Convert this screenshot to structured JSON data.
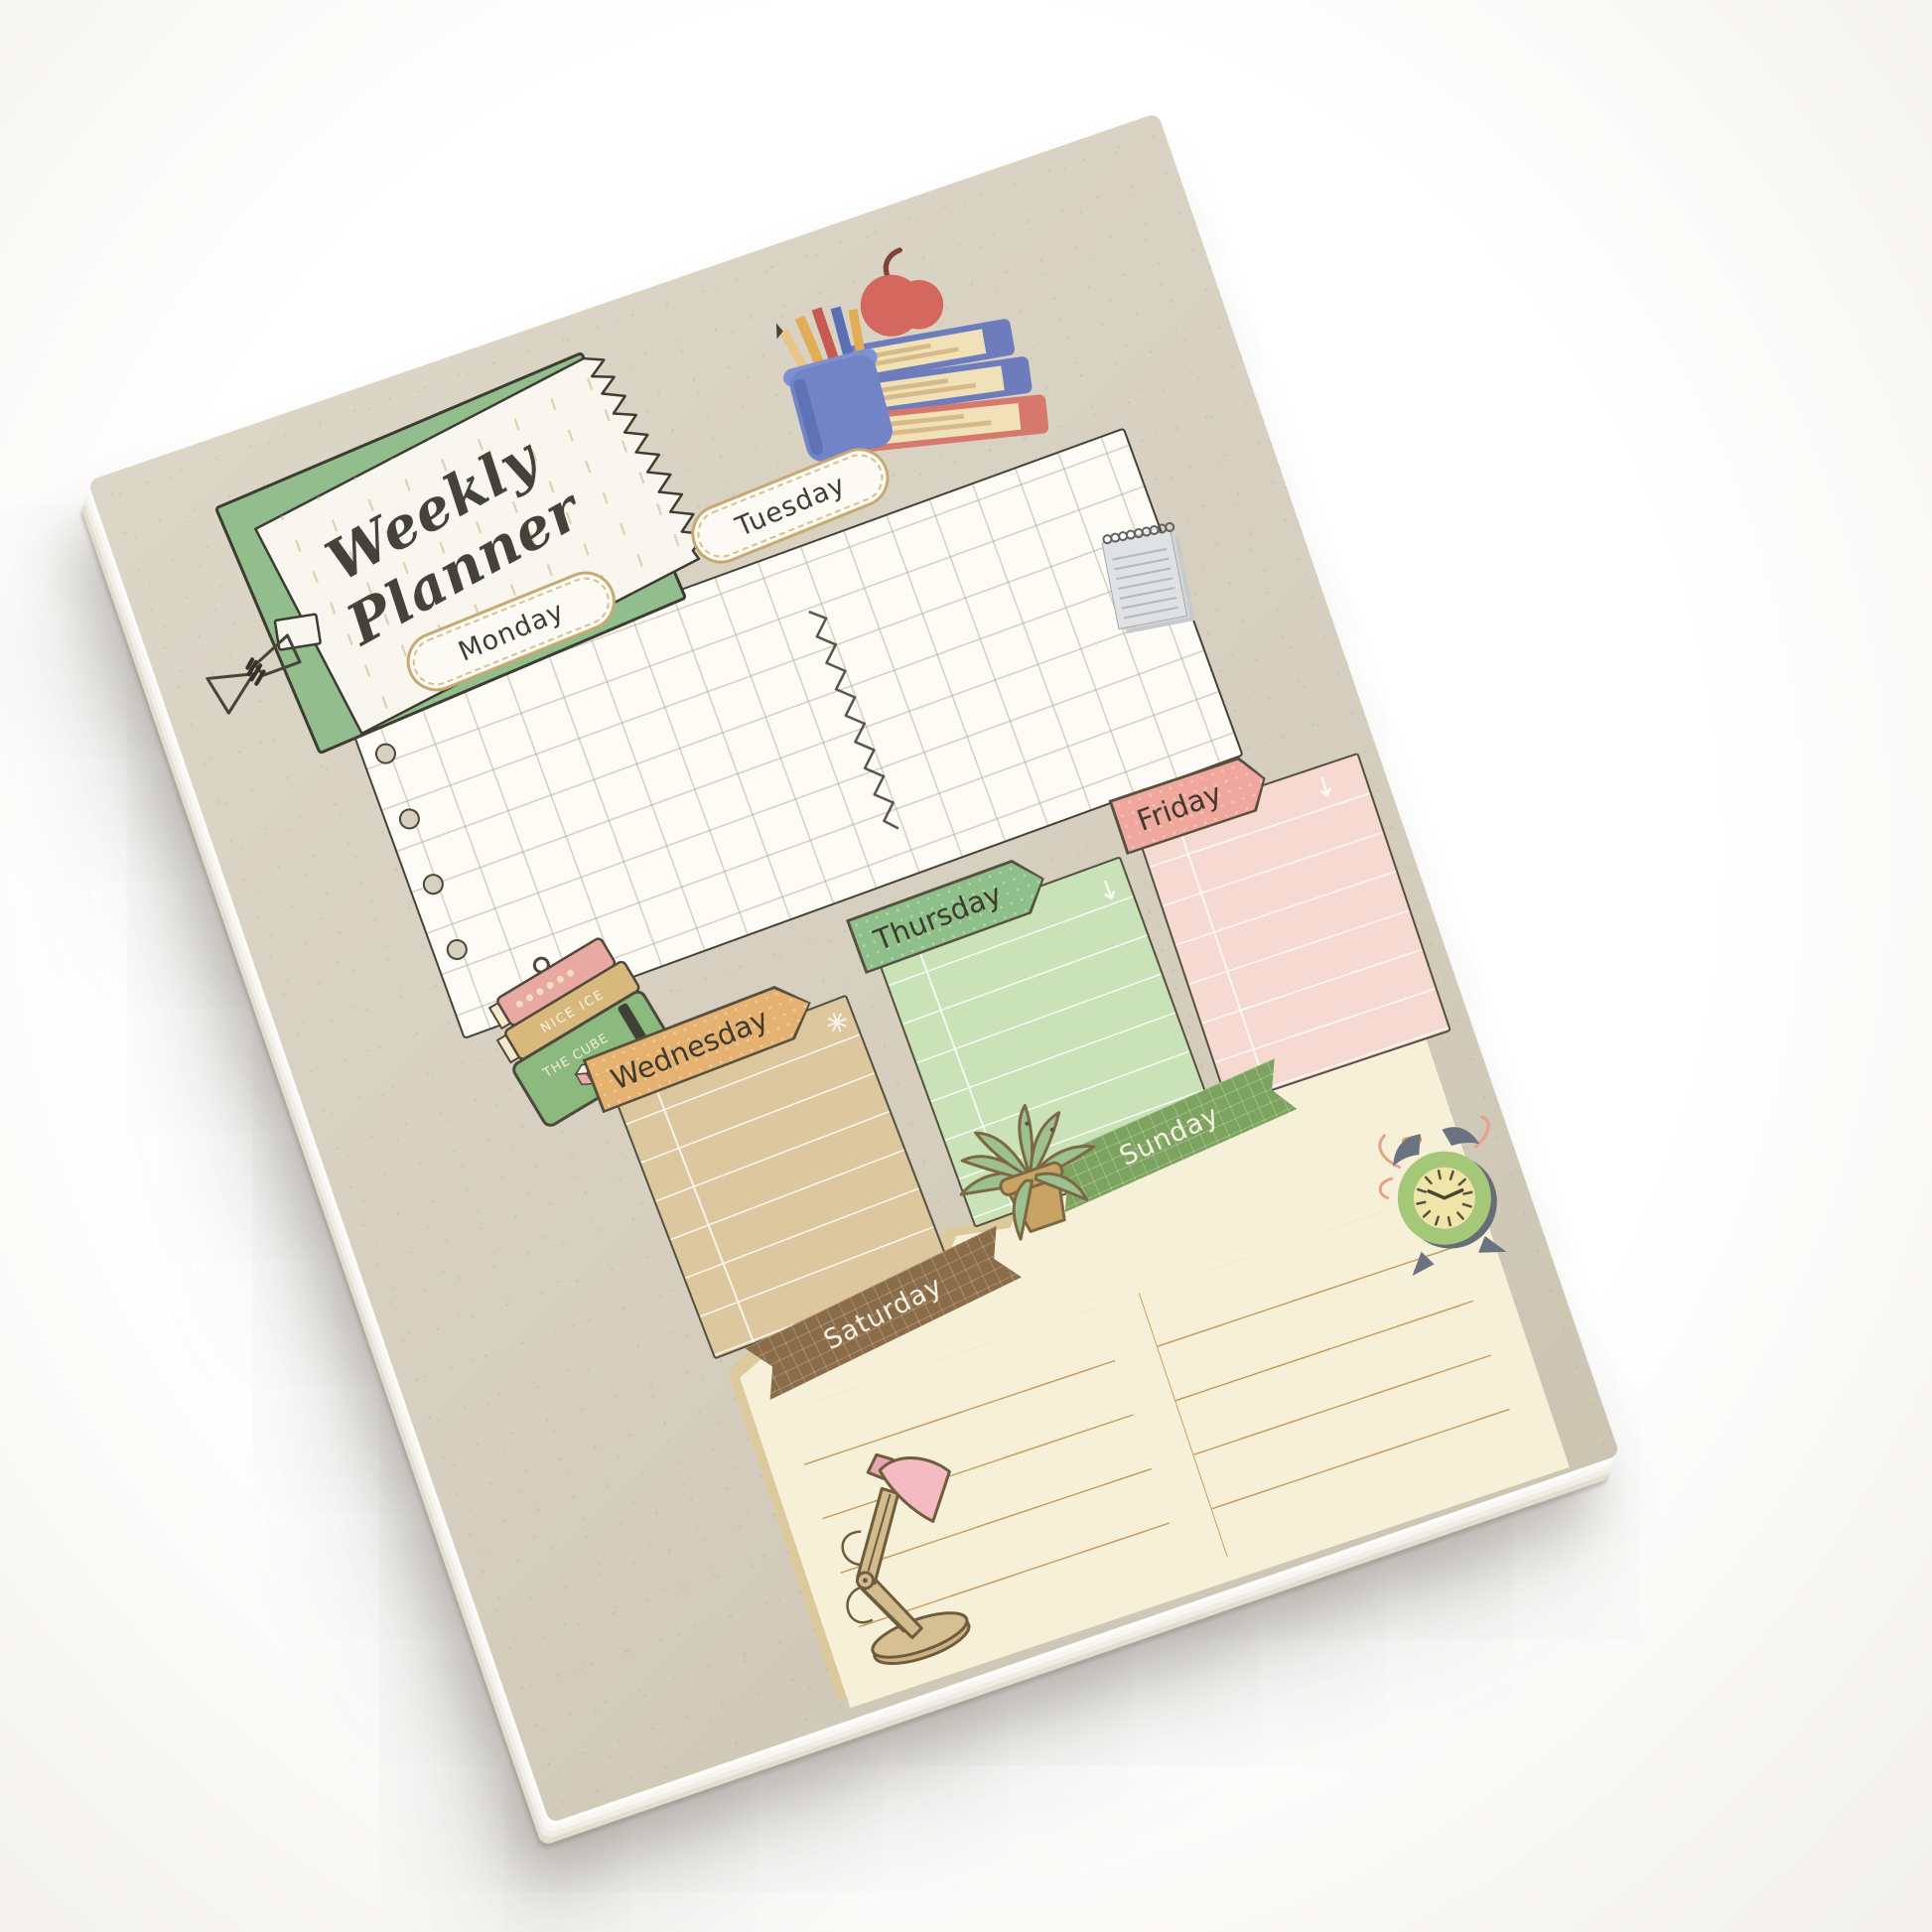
{
  "scene": {
    "type": "product-photo",
    "background_color": "#ffffff",
    "subject": "paper weekly planner notepad"
  },
  "planner": {
    "title": {
      "line1": "Weekly",
      "line2": "Planner"
    },
    "day_labels": {
      "monday": "Monday",
      "tuesday": "Tuesday",
      "wednesday": "Wednesday",
      "thursday": "Thursday",
      "friday": "Friday",
      "saturday": "Saturday",
      "sunday": "Sunday"
    },
    "stickers": {
      "green_book_title": "THE CUBE",
      "tan_book_spine": "NICE ICE"
    },
    "colors": {
      "pad_paper": "#d7d0bf",
      "title_frame_green": "#92bd8d",
      "card_white": "#f8f6ee",
      "pill_border_tan": "#c7a971",
      "wednesday_banner": "#e6b271",
      "wednesday_body": "#dcc79e",
      "thursday_banner": "#8fc089",
      "thursday_body": "#c9e2b8",
      "friday_banner": "#f0a89e",
      "friday_body": "#f6d9d1",
      "saturday_ribbon": "#8a6c49",
      "sunday_ribbon": "#7ca35f",
      "weekend_paper": "#f7f0d8",
      "ink_outline": "#45423a",
      "apple_red": "#d5685e",
      "book_blue": "#6c7cbd",
      "book_red": "#d6786b",
      "clock_green": "#a4c878",
      "lamp_shade_pink": "#f3bac2",
      "plant_green": "#9cc08e"
    }
  }
}
